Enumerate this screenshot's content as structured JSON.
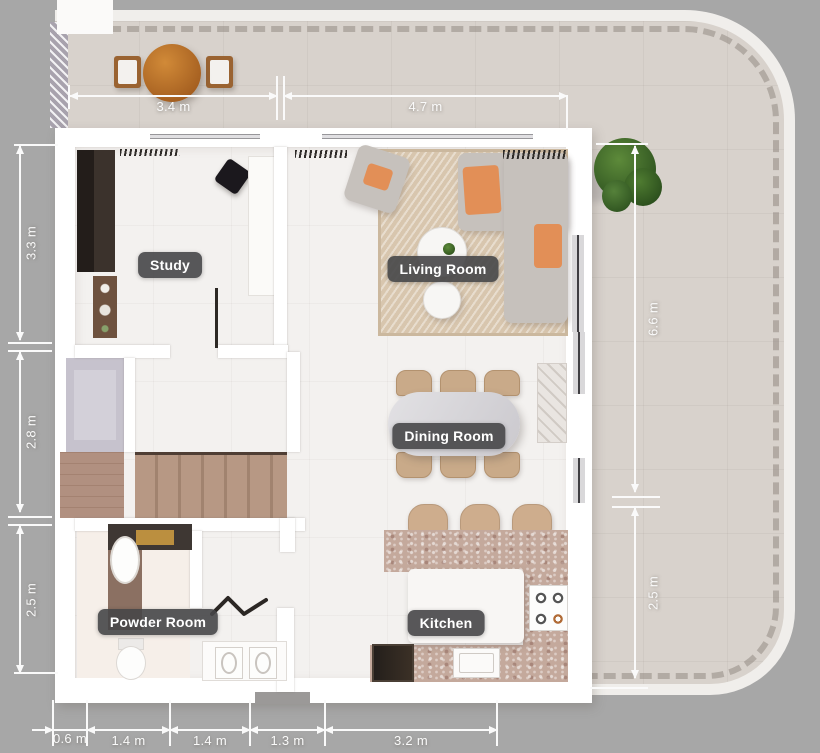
{
  "rooms": [
    {
      "id": "study",
      "label": "Study"
    },
    {
      "id": "living-room",
      "label": "Living Room"
    },
    {
      "id": "dining-room",
      "label": "Dining Room"
    },
    {
      "id": "powder-room",
      "label": "Powder Room"
    },
    {
      "id": "kitchen",
      "label": "Kitchen"
    }
  ],
  "dimensions": {
    "top": [
      "3.4 m",
      "4.7 m"
    ],
    "left": [
      "3.3 m",
      "2.8 m",
      "2.5 m"
    ],
    "right": [
      "6.6 m",
      "2.5 m"
    ],
    "bottom": [
      "0.6 m",
      "1.4 m",
      "1.4 m",
      "1.3 m",
      "3.2 m"
    ]
  },
  "colors": {
    "background": "#a7a7a7",
    "wall": "#ffffff",
    "interior_floor": "#f3f1ef",
    "terrace_floor": "#d8d2cc",
    "terrace_rim": "#f0eeeb",
    "label_bg": "#464648",
    "label_text": "#ffffff",
    "dimension_text": "#fafafa",
    "wood_table": "#b06a28",
    "cushion_accent": "#e28f57",
    "counter_terrazzo": "#c4a99c",
    "stair_wood": "#b79884",
    "plant_green": "#45702e"
  },
  "icons": {
    "tree-icon": "layered green circles",
    "folding-door-icon": "zigzag polyline",
    "washer-icon": "square with circle drum",
    "stove-icon": "4 burner rings",
    "arrow-icon": "dimension arrowheads"
  }
}
